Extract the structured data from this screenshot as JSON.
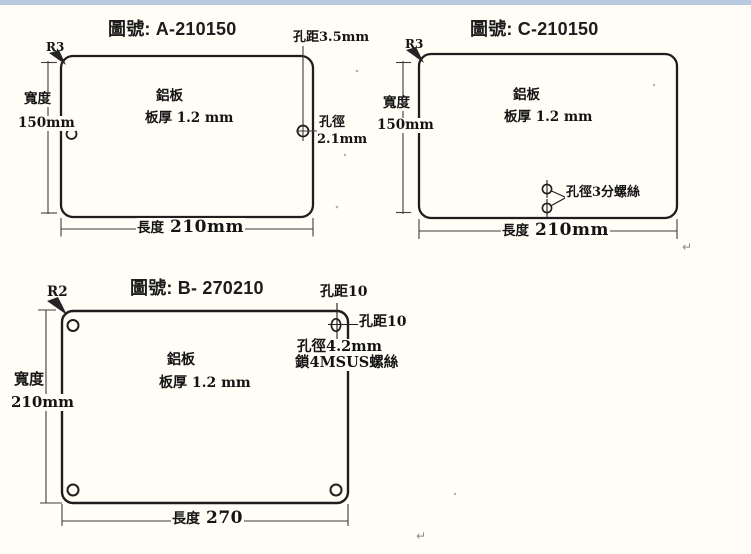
{
  "page": {
    "background_color": "#fffdf6",
    "top_bar_color": "#b9c9df",
    "line_color": "#222222"
  },
  "drawing_a": {
    "title": "圖號: A-210150",
    "corner_radius_label": "R3",
    "hole_pitch_label": "孔距3.5mm",
    "material_label": "鋁板",
    "thickness_label": "板厚 1.2 mm",
    "hole_dia_label": "孔徑",
    "hole_dia_value": "2.1mm",
    "width_label": "寬度",
    "width_value": "150mm",
    "length_label": "長度",
    "length_value": "210mm"
  },
  "drawing_c": {
    "title": "圖號: C-210150",
    "corner_radius_label": "R3",
    "material_label": "鋁板",
    "thickness_label": "板厚 1.2 mm",
    "hole_note_label": "孔徑3分螺絲",
    "width_label": "寬度",
    "width_value": "150mm",
    "length_label": "長度",
    "length_value": "210mm",
    "paragraph_mark": "↵"
  },
  "drawing_b": {
    "title": "圖號: B- 270210",
    "corner_radius_label": "R2",
    "hole_pitch_top_label": "孔距10",
    "hole_pitch_right_label": "孔距10",
    "hole_dia_label": "孔徑4.2mm",
    "screw_note_label": "鎖4MSUS螺絲",
    "material_label": "鋁板",
    "thickness_label": "板厚 1.2 mm",
    "width_label": "寬度",
    "width_value": "210mm",
    "length_label": "長度",
    "length_value": "270",
    "paragraph_mark": "↵"
  }
}
